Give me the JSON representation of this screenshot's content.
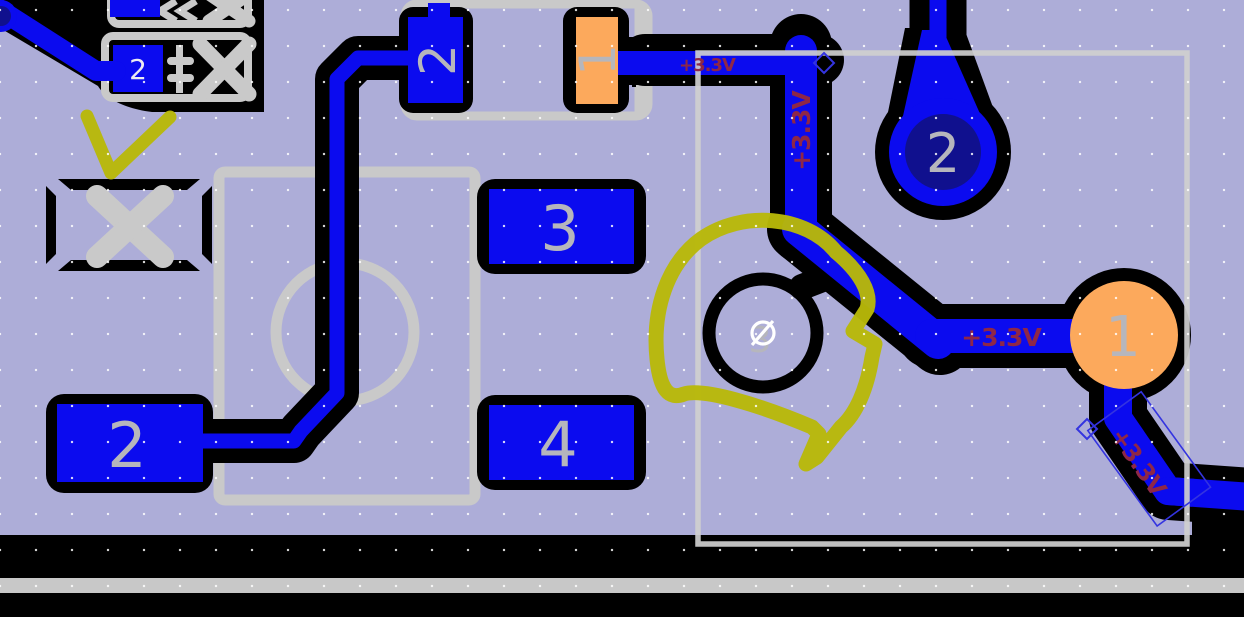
{
  "canvas": {
    "title": "pcb-editor-canvas"
  },
  "nets": {
    "label_top_horizontal": "+3.3V",
    "label_vertical": "+3.3V",
    "label_left_of_round_pad": "+3.3V",
    "label_diagonal_bottom": "+3.3V"
  },
  "pads": {
    "small_smd_pad": "2",
    "capacitor_pad_negative": "2",
    "capacitor_pad_positive": "1",
    "ic_pad_left": "2",
    "ic_pad_right_top": "3",
    "ic_pad_right_bottom": "4",
    "center_hole_pad": "3",
    "teardrop_via_top": "2",
    "round_orange_pad": "1"
  },
  "colors": {
    "board": "#adadd8",
    "copper_trace": "#0b0bef",
    "pad_orange": "#fca95c",
    "drill_navy": "#10108e",
    "silkscreen_gray": "#c9c9c9",
    "annotation_olive": "#b8b808",
    "net_label_red": "#8e2747",
    "clearance_black": "#000000",
    "bottom_stripe_gray": "#c8c8c8",
    "grid_dot": "#ffffff"
  }
}
